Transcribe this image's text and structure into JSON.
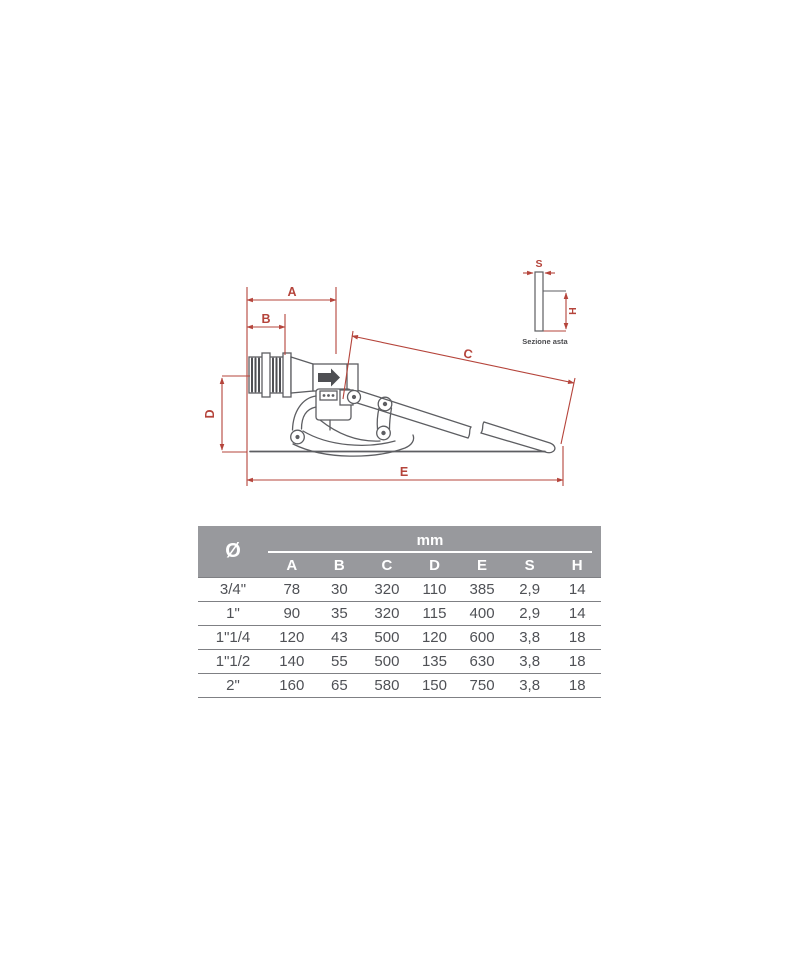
{
  "drawing": {
    "labels": {
      "a": "A",
      "b": "B",
      "c": "C",
      "d": "D",
      "e": "E",
      "s": "S",
      "h": "H"
    },
    "section_caption": "Sezione asta",
    "colors": {
      "dimension": "#b5443b",
      "line": "#5d5e62"
    }
  },
  "table": {
    "diameter_symbol": "Ø",
    "unit_label": "mm",
    "columns": [
      "A",
      "B",
      "C",
      "D",
      "E",
      "S",
      "H"
    ],
    "rows": [
      {
        "size": "3/4\"",
        "values": [
          "78",
          "30",
          "320",
          "110",
          "385",
          "2,9",
          "14"
        ]
      },
      {
        "size": "1\"",
        "values": [
          "90",
          "35",
          "320",
          "115",
          "400",
          "2,9",
          "14"
        ]
      },
      {
        "size": "1\"1/4",
        "values": [
          "120",
          "43",
          "500",
          "120",
          "600",
          "3,8",
          "18"
        ]
      },
      {
        "size": "1\"1/2",
        "values": [
          "140",
          "55",
          "500",
          "135",
          "630",
          "3,8",
          "18"
        ]
      },
      {
        "size": "2\"",
        "values": [
          "160",
          "65",
          "580",
          "150",
          "750",
          "3,8",
          "18"
        ]
      }
    ],
    "colors": {
      "header_bg": "#98999d",
      "header_text": "#ffffff",
      "body_text": "#4f5156",
      "grid_line": "#7f8084"
    }
  }
}
